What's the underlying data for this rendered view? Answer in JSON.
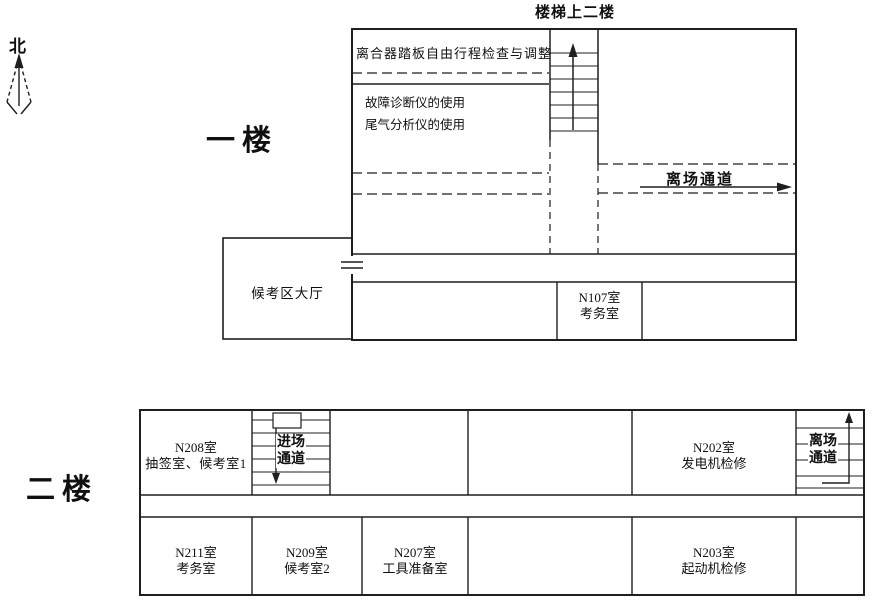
{
  "compass": {
    "north_label": "北"
  },
  "floor1": {
    "title": "一楼",
    "stairs_top_label": "楼梯上二楼",
    "clutch_room_label": "离合器踏板自由行程检查与调整",
    "diag_room_line1": "故障诊断仪的使用",
    "diag_room_line2": "尾气分析仪的使用",
    "exit_corridor_label": "离场通道",
    "waiting_hall_label": "候考区大厅",
    "n107_line1": "N107室",
    "n107_line2": "考务室"
  },
  "floor2": {
    "title": "二楼",
    "entry_line1": "进场",
    "entry_line2": "通道",
    "exit_line1": "离场",
    "exit_line2": "通道",
    "n208_line1": "N208室",
    "n208_line2": "抽签室、候考室1",
    "n202_line1": "N202室",
    "n202_line2": "发电机检修",
    "n211_line1": "N211室",
    "n211_line2": "考务室",
    "n209_line1": "N209室",
    "n209_line2": "候考室2",
    "n207_line1": "N207室",
    "n207_line2": "工具准备室",
    "n203_line1": "N203室",
    "n203_line2": "起动机检修"
  },
  "colors": {
    "line": "#1f1f1f",
    "text": "#101010",
    "background": "#ffffff"
  }
}
